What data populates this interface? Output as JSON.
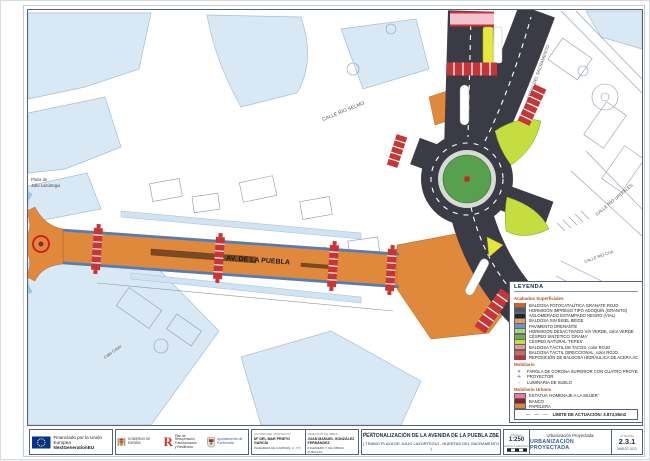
{
  "map": {
    "labels": {
      "plaza_line1": "Plaza de",
      "plaza_line2": "Julio Lazúrtegui",
      "av_puebla": "AV. DE LA PUEBLA",
      "calle_rio_selmo": "CALLE RÍO SELMO",
      "av_huertas": "AV. HUERTAS DEL SACRAMENTO",
      "calle_rio_urdiales": "CALLE RÍO URDIALES",
      "calle_rio_cua": "CALLE RÍO CÚA",
      "calle_cristo": "Calle Cristo"
    },
    "colors": {
      "building": "#d9e8f5",
      "building_light": "#cfe3f2",
      "road": "#3b3b46",
      "avenue": "#e0883c",
      "median": "#7a4a22",
      "edge_blue": "#4a7fc1",
      "crosswalk": "#c93535",
      "pink_cross": "#f3c3cf",
      "cesped": "#57a04e",
      "apron": "#d6dbd6",
      "island": "#c5dd3f",
      "tepes": "#e3e63c",
      "lane_yellow": "#e6e83e",
      "statue_red": "#cc2222"
    }
  },
  "legend": {
    "title": "LEYENDA",
    "surfaces_heading": "Acabados Superficiales",
    "items": [
      {
        "label": "BALDOSA FOTOCATALÍTICA GRANATE ROJO",
        "color": "#d2622a"
      },
      {
        "label": "HORMIGÓN IMPRESO TIPO ADOQUÍN (GRANITO)",
        "color": "#4a5878"
      },
      {
        "label": "AGLOMERADO ESTAMPADO NEGRO (VIAL)",
        "color": "#1e2430"
      },
      {
        "label": "BALDOSA SIN BISEL BEIGE",
        "color": "#e89a66"
      },
      {
        "label": "PAVIMENTO DRENANTE",
        "color": "#6d93c4"
      },
      {
        "label": "HORMIGÓN DESACTIVADO VÍA VERDE, color VERDE",
        "color": "#a9d387"
      },
      {
        "label": "CÉSPED SINTÉTICO 'GRAMA'",
        "color": "#6fae4e"
      },
      {
        "label": "CÉSPED NATURAL 'TEPES'",
        "color": "#c3dd49"
      },
      {
        "label": "BALDOSA TÁCTIL DE TACOS, color ROJO",
        "color": "#e39b9b"
      },
      {
        "label": "BALDOSA TÁCTIL DIRECCIONAL, color ROJO",
        "color": "#cf6a52"
      },
      {
        "label": "REPOSICIÓN DE BALDOSA HIDRÁULICA DE ACERA ACTUAL",
        "color": "#bc2f3e"
      }
    ],
    "mobiliario_heading": "Mobiliario",
    "mobiliario": [
      {
        "symbol": "✕",
        "label": "FAROLA DE CORONA SUPERIOR CON CUATRO PROYECTORES"
      },
      {
        "symbol": "✛",
        "label": "PROYECTOR"
      },
      {
        "symbol": "◦",
        "label": "LUMINARIA DE SUELO"
      }
    ],
    "urbano_heading": "Mobiliario Urbano",
    "urbano": [
      {
        "label": "ESTATUA 'HOMENAJE A LA MUJER'",
        "color": "#e87ba0"
      },
      {
        "label": "BANCO",
        "color": "#8a1f2d"
      },
      {
        "label": "PAPELERA",
        "color": "#d9883c"
      }
    ],
    "limite_symbol": "— — —",
    "limite_label": "LÍMITE DE ACTUACIÓN: 3.873,55m2"
  },
  "titleblock": {
    "eu": {
      "line1": "Financiado por la Unión Europea",
      "line2": "NextGenerationEU"
    },
    "gobierno": "GOBIERNO DE ESPAÑA",
    "plan": {
      "r": "R",
      "line1": "Plan de Recuperación,",
      "line2": "Transformación",
      "line3": "y Resiliencia"
    },
    "ayuntamiento": "Ayuntamiento de Ponferrada",
    "author1": {
      "header": "AUTORA DEL PROYECTO:",
      "name": "Mª DEL MAR PRIETO GARCÍA",
      "role": "INGENIERA DE CAMINOS, C. Y P."
    },
    "author2": {
      "header": "DIRECTOR DE OBRA:",
      "name": "JUAN MANUEL GONZÁLEZ FERNÁNDEZ",
      "role": "INGENIERO T. DE OBRAS PÚBLICAS"
    },
    "title_label": "PLANO:",
    "title_line1": "PEATONALIZACIÓN DE LA AVENIDA DE LA PUEBLA ZBE",
    "title_line2": "( TRAMO PLAZA DE JULIO LAZÚRTEGUI - HUERTAS DEL SACRAMENTO )",
    "scale": {
      "label": "ESCALA",
      "value": "1:250",
      "graphic_label": "ESCALA GRÁFICA"
    },
    "sheet": {
      "header": "Urbanización Proyectada:",
      "name": "URBANIZACIÓN PROYECTADA",
      "plano_label": "Nº PLANO",
      "plano": "2.3.1",
      "fecha": "MARZO 2023"
    }
  }
}
